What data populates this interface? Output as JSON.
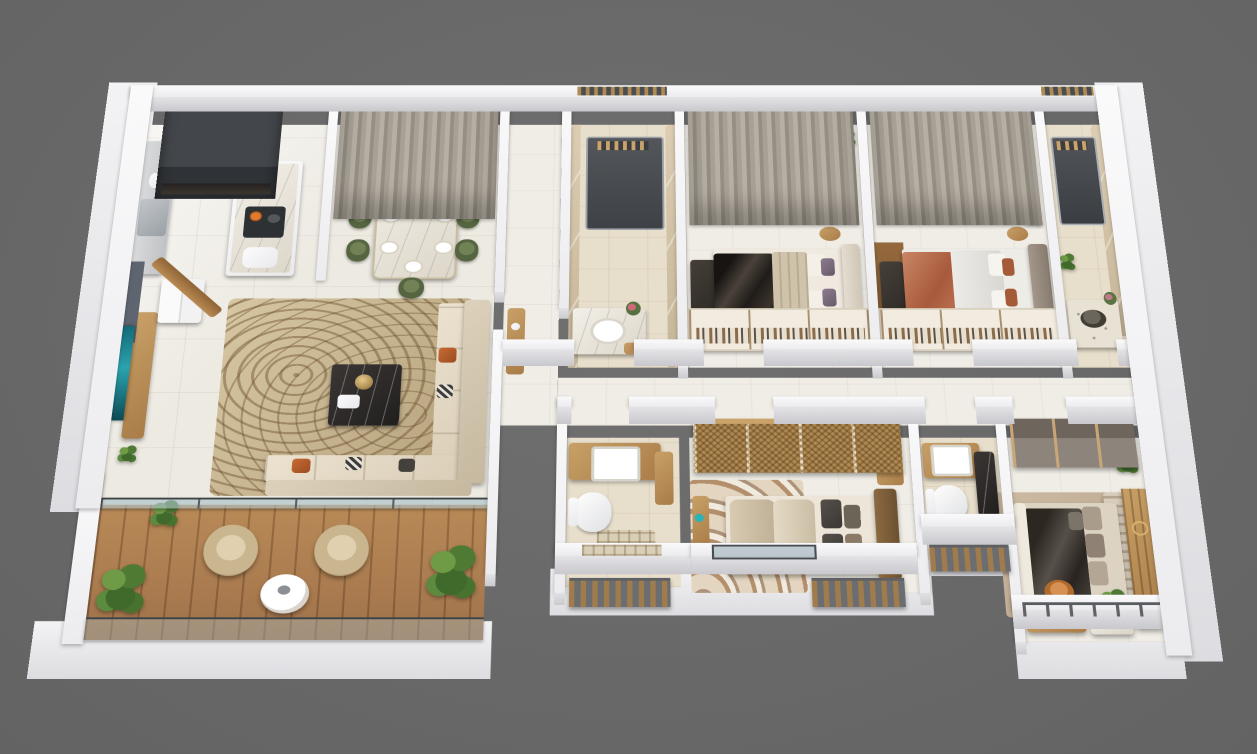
{
  "scene": {
    "label": "3D isometric apartment floor plan render",
    "background_color": "#6b6b6b",
    "view": "cutaway dollhouse top-down perspective",
    "visible_text": ""
  },
  "palette": {
    "background": "#6b6b6b",
    "walls": "#f2f2f4",
    "floor_tile": "#edeae2",
    "bathroom_marble": "#d5c6ab",
    "wood": "#b98a57",
    "curtain": "#a7a095",
    "dining_chair_green": "#5f7150",
    "sofa_cream": "#e7ddcb",
    "accent_orange": "#b35a2c",
    "blanket_dark": "#3a342e",
    "blanket_terracotta": "#bc6f4e",
    "plant_green": "#4e7a34",
    "glass_railing": "#a8c0c8"
  },
  "rooms": {
    "kitchen": {
      "label": "kitchen",
      "furniture": [
        "window-opening",
        "counter",
        "range",
        "island",
        "cooktop",
        "coffee-machine",
        "mixer",
        "fridge"
      ]
    },
    "dining": {
      "label": "dining area",
      "furniture": [
        "marble-dining-table",
        "8-green-chairs",
        "plates",
        "flower-centerpiece",
        "curtains"
      ]
    },
    "living": {
      "label": "living room",
      "furniture": [
        "tv",
        "tv-console",
        "area-rug",
        "coffee-table",
        "l-shaped-sofa",
        "orange-pillows",
        "entry-door",
        "plant"
      ]
    },
    "balcony": {
      "label": "balcony",
      "furniture": [
        "wood-deck",
        "2-armchairs",
        "round-table",
        "potted-plants",
        "glass-railing"
      ]
    },
    "hallway": {
      "label": "hallway",
      "furniture": [
        "console"
      ]
    },
    "bathroom1": {
      "label": "bathroom 1",
      "furniture": [
        "shower",
        "vanity",
        "round-basin",
        "flowers"
      ]
    },
    "bedroom1": {
      "label": "bedroom 1",
      "furniture": [
        "double-bed",
        "dark-blanket",
        "purple-pillows",
        "headboard",
        "tv-chest",
        "open-wardrobe",
        "curtains",
        "side-tables"
      ]
    },
    "bedroom2": {
      "label": "bedroom 2",
      "furniture": [
        "double-bed",
        "terracotta-blanket",
        "headboard",
        "tv-chest",
        "open-wardrobe",
        "curtains",
        "side-tables"
      ]
    },
    "bathroom2": {
      "label": "bathroom 2",
      "furniture": [
        "shower",
        "vanity",
        "dark-round-basin",
        "plant"
      ]
    },
    "bathroom3": {
      "label": "bathroom 3",
      "furniture": [
        "vanity",
        "square-sink",
        "toilet",
        "plaid-mat",
        "plaid-window",
        "slat-railing"
      ]
    },
    "bedroom3": {
      "label": "bedroom 3",
      "furniture": [
        "double-bed",
        "quilted-bedding",
        "dark-pillows",
        "woven-wardrobe",
        "wavy-rug",
        "makeup-vanity",
        "glass-window",
        "slat-railing"
      ]
    },
    "bathroom4": {
      "label": "bathroom 4",
      "furniture": [
        "vanity",
        "square-sink",
        "toilet",
        "dark-counter",
        "slat-railing"
      ]
    },
    "master": {
      "label": "master bedroom",
      "furniture": [
        "king-bed",
        "dark-blanket",
        "wood-panel-wall",
        "tufted-bench",
        "wardrobe",
        "desk",
        "orange-chair",
        "nightstand",
        "plant",
        "rug",
        "metal-railing"
      ]
    }
  }
}
